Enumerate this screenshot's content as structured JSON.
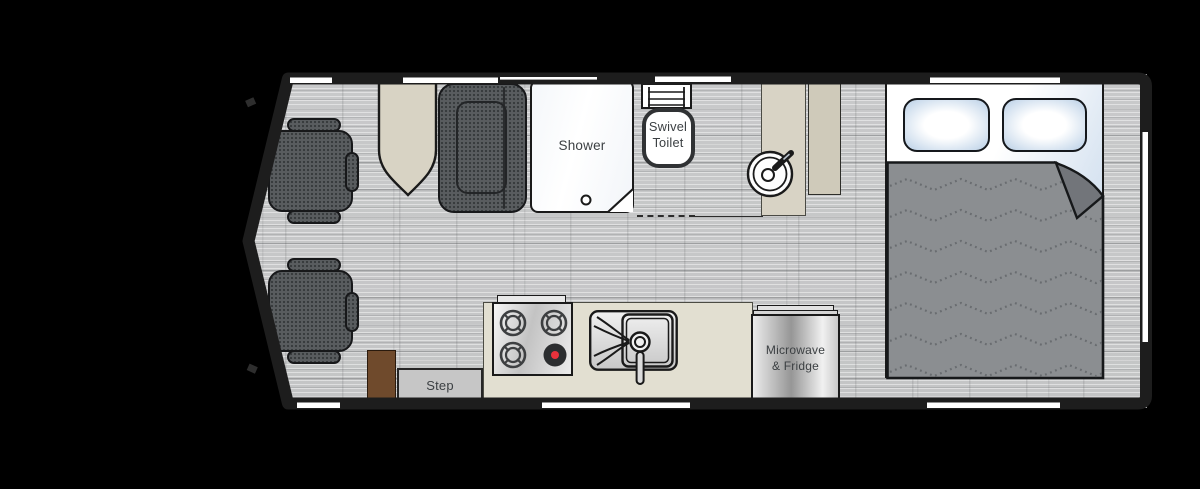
{
  "scene": {
    "type": "rv-camper-van-floorplan",
    "background": "#000000"
  },
  "labels": {
    "shower": "Shower",
    "toilet_line1": "Swivel",
    "toilet_line2": "Toilet",
    "appliance_line1": "Microwave",
    "appliance_line2": "& Fridge",
    "step": "Step"
  },
  "colors": {
    "floor": "#c6c7c8",
    "wall": "#1d1d1d",
    "upholstery_gray": "#595c5f",
    "blanket_gray": "#8b8e91",
    "blanket_fold": "#72757a",
    "counter_cream": "#e2dfd1",
    "table_beige": "#d8d3c4",
    "vanity_beige": "#cfcaba",
    "cabinet_brown": "#6f4a2c",
    "step_gray": "#c6c6c6",
    "pillow_blue": "#b9cfe6",
    "burner_red": "#e8323c",
    "label_text": "#3c4043"
  },
  "fixtures": [
    "driver-seat",
    "passenger-seat",
    "dinette-table",
    "sofa",
    "shower",
    "swivel-toilet",
    "vanity-counter",
    "wardrobe-counter",
    "round-bath-sink",
    "kitchen-counter",
    "stove",
    "kitchen-sink",
    "microwave-fridge",
    "entry-step",
    "entry-cabinet",
    "bed",
    "pillow-left",
    "pillow-right",
    "blanket"
  ]
}
